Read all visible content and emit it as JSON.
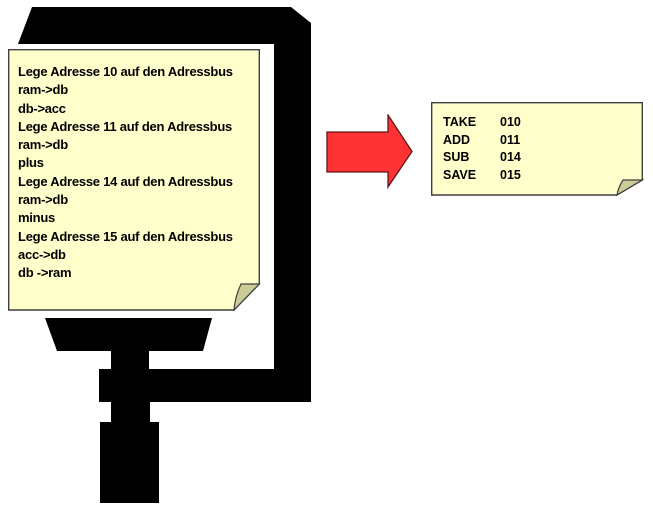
{
  "diagram": {
    "description": "pseudo-code program clamped in a screw clamp transformed into assembly instructions",
    "source_note": {
      "lines": [
        "Lege Adresse 10 auf den Adressbus",
        "ram->db",
        "db->acc",
        "Lege Adresse 11 auf den Adressbus",
        "ram->db",
        "plus",
        "Lege Adresse 14 auf den Adressbus",
        "ram->db",
        "minus",
        "Lege Adresse 15 auf den Adressbus",
        "acc->db",
        "db ->ram"
      ]
    },
    "result_note": {
      "rows": [
        {
          "op": "TAKE",
          "addr": "010"
        },
        {
          "op": "ADD",
          "addr": "011"
        },
        {
          "op": "SUB",
          "addr": "014"
        },
        {
          "op": "SAVE",
          "addr": "015"
        }
      ]
    },
    "icons": {
      "clamp": "screw-clamp-silhouette",
      "arrow": "right-arrow",
      "notes": "folded-corner-sticky-note"
    },
    "colors": {
      "background": "#FFFFFF",
      "silhouette": "#000000",
      "note_fill": "#FFFFCC",
      "note_fold": "#CCCC99",
      "note_border": "#3F3F3F",
      "arrow_fill": "#FF3333",
      "arrow_border": "#5F1717",
      "text": "#000000"
    }
  }
}
